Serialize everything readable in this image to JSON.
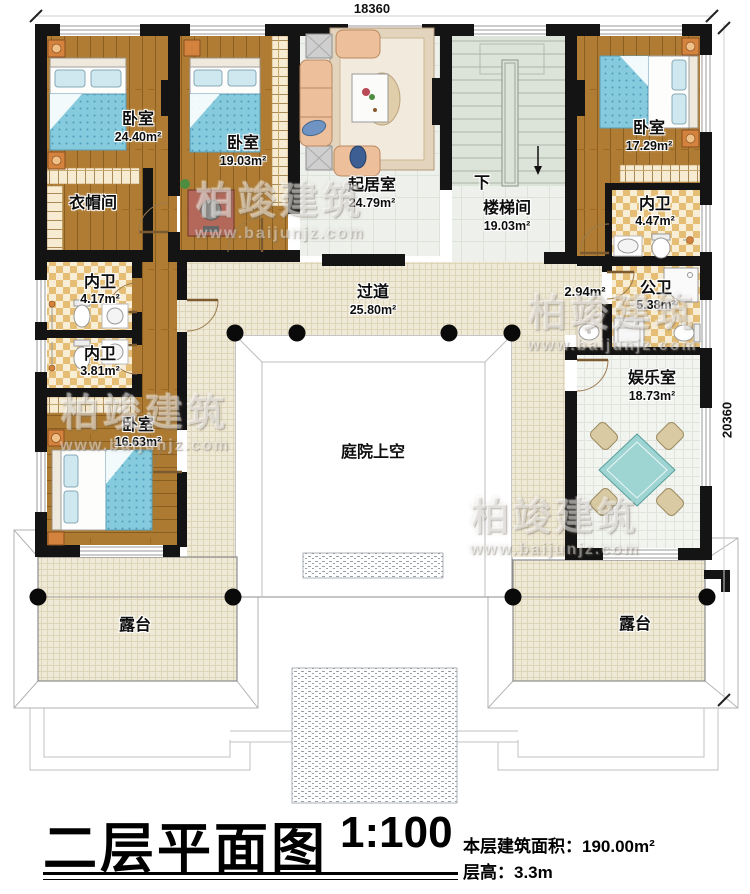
{
  "dimensions": {
    "top_mm": "18360",
    "right_mm": "20360"
  },
  "rooms": {
    "bedroom_tl": {
      "name": "卧室",
      "area": "24.40m²"
    },
    "cloakroom": {
      "name": "衣帽间"
    },
    "bedroom_tm": {
      "name": "卧室",
      "area": "19.03m²"
    },
    "living_room": {
      "name": "起居室",
      "area": "24.79m²"
    },
    "stairwell": {
      "name": "楼梯间",
      "area": "19.03m²",
      "down": "下"
    },
    "bedroom_tr": {
      "name": "卧室",
      "area": "17.29m²"
    },
    "bath_tr": {
      "name": "内卫",
      "area": "4.47m²"
    },
    "bath_l1": {
      "name": "内卫",
      "area": "4.17m²"
    },
    "bath_l2": {
      "name": "内卫",
      "area": "3.81m²"
    },
    "bedroom_bl": {
      "name": "卧室",
      "area": "16.63m²"
    },
    "niche": {
      "area": "2.94m²"
    },
    "public_bath": {
      "name": "公卫",
      "area": "5.38m²"
    },
    "corridor": {
      "name": "过道",
      "area": "25.80m²"
    },
    "courtyard": {
      "name": "庭院上空"
    },
    "entertainment": {
      "name": "娱乐室",
      "area": "18.73m²"
    },
    "terrace_left": {
      "name": "露台"
    },
    "terrace_right": {
      "name": "露台"
    }
  },
  "title_block": {
    "title": "二层平面图",
    "scale": "1:100",
    "floor_area": "本层建筑面积：190.00m²",
    "floor_height": "层高：3.3m"
  },
  "watermark": {
    "brand": "柏竣建筑",
    "url": "www.baijunjz.com"
  },
  "colors": {
    "wall": "#141414",
    "wood": "#b07c33",
    "checker": "#e5bd74",
    "tile": "#efe9d7",
    "blanket": "#85cadd",
    "table": "#9ed4d2"
  }
}
